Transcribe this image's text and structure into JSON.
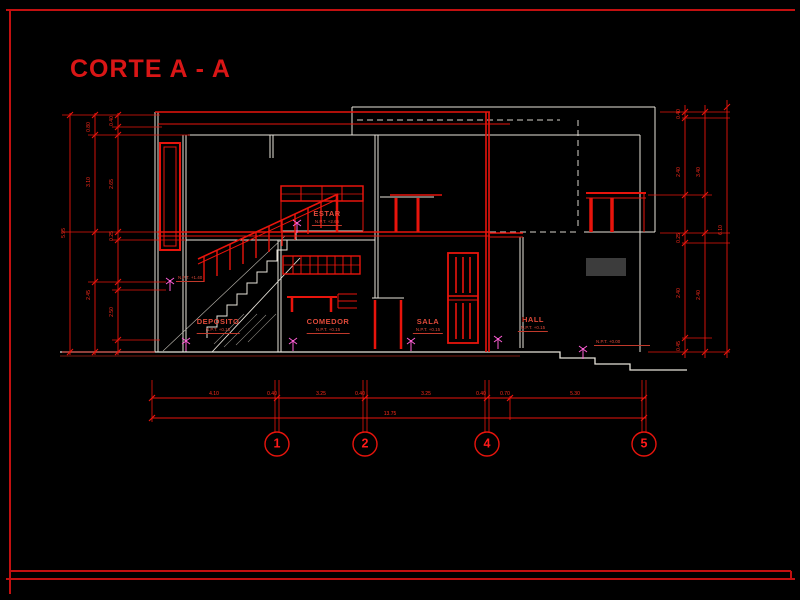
{
  "title": "CORTE A - A",
  "rooms": {
    "estar": {
      "name": "ESTAR",
      "level": "N.P.T. +2.65"
    },
    "deposito": {
      "name": "DEPOSITO",
      "level": "N.P.T. +0.15"
    },
    "comedor": {
      "name": "COMEDOR",
      "level": "N.P.T. +0.15"
    },
    "sala": {
      "name": "SALA",
      "level": "N.P.T. +0.15"
    },
    "hall": {
      "name": "HALL",
      "level": "N.P.T. +0.15"
    }
  },
  "levels": {
    "exterior": "N.P.T. +0.00",
    "stair_mid": "N.P.T. +1.40"
  },
  "grid": {
    "bubbles": [
      "1",
      "2",
      "4",
      "5"
    ]
  },
  "dims": {
    "bottom": {
      "segments": [
        "4.10",
        "0.40",
        "3.25",
        "0.40",
        "3.25",
        "0.40",
        "0.70",
        "5.30"
      ],
      "total": "13.75"
    },
    "left": [
      "5.95",
      "0.80",
      "3.10",
      "2.45",
      "0.40",
      "2.65",
      "0.25",
      "2.50"
    ],
    "right": [
      "0.40",
      "2.40",
      "0.25",
      "2.40",
      "0.45",
      "3.40",
      "2.40",
      "6.10"
    ]
  },
  "colors": {
    "background": "#000000",
    "line_red": "#e8140c",
    "line_white": "#e7e3da",
    "marker_magenta": "#ff5fd7",
    "beam_gray": "#3c3c3c",
    "title_red": "#d91616"
  }
}
